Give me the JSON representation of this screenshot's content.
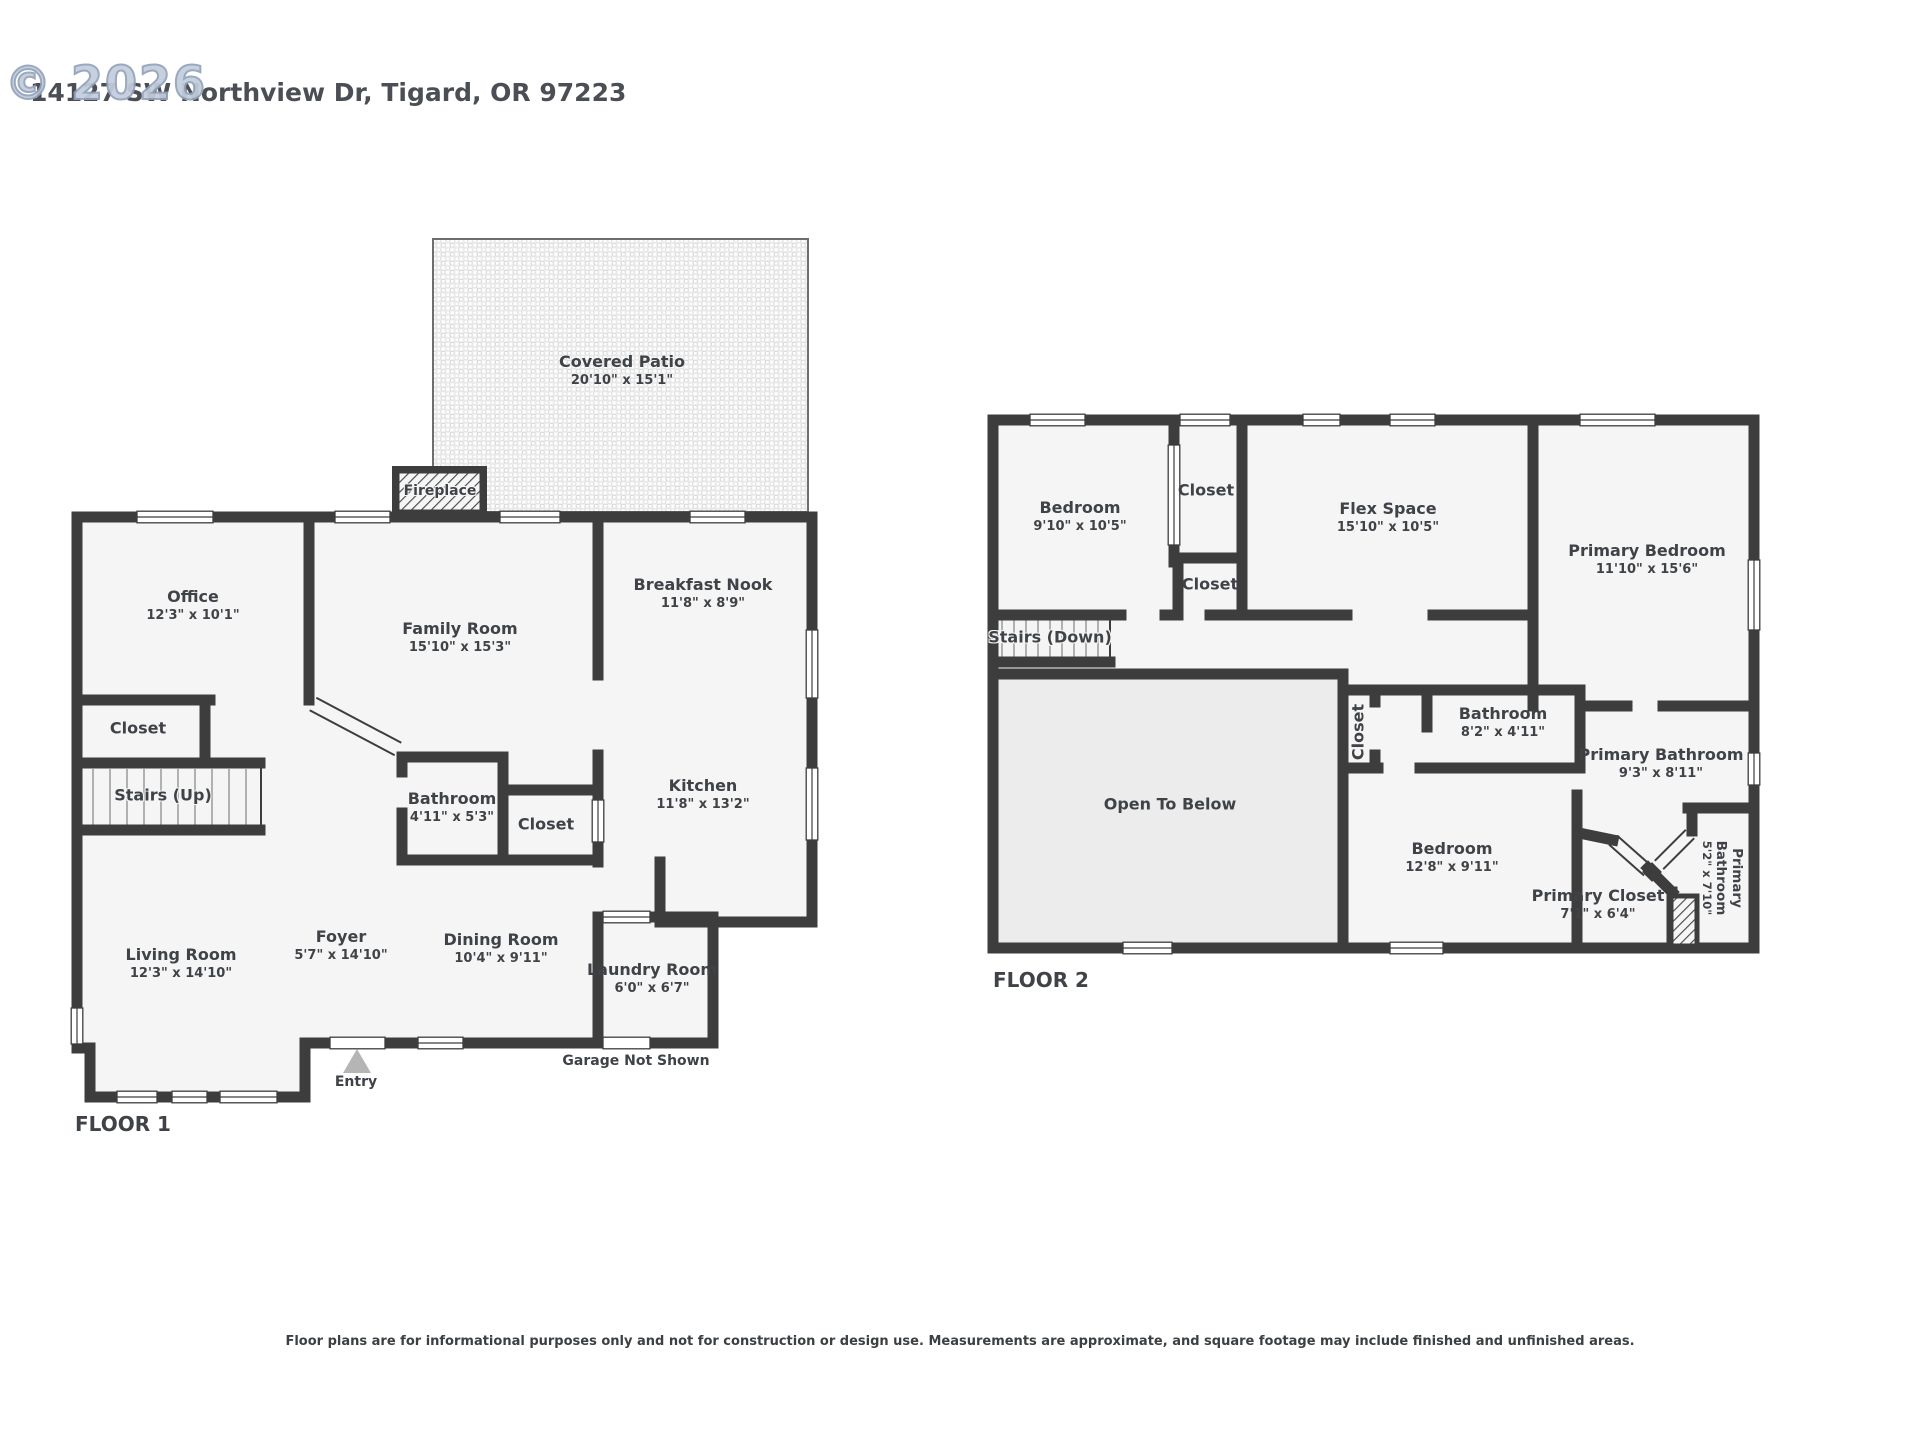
{
  "watermark": "© 2026",
  "address": "14127 SW Northview Dr, Tigard, OR 97223",
  "floor1": {
    "label": "FLOOR 1",
    "rooms": {
      "covered_patio": {
        "name": "Covered Patio",
        "dims": "20'10\" x 15'1\""
      },
      "fireplace": {
        "name": "Fireplace"
      },
      "office": {
        "name": "Office",
        "dims": "12'3\" x 10'1\""
      },
      "family_room": {
        "name": "Family Room",
        "dims": "15'10\" x 15'3\""
      },
      "breakfast_nook": {
        "name": "Breakfast Nook",
        "dims": "11'8\" x 8'9\""
      },
      "kitchen": {
        "name": "Kitchen",
        "dims": "11'8\" x 13'2\""
      },
      "bathroom": {
        "name": "Bathroom",
        "dims": "4'11\" x 5'3\""
      },
      "closet_hall": {
        "name": "Closet"
      },
      "closet_office": {
        "name": "Closet"
      },
      "stairs_up": {
        "name": "Stairs (Up)"
      },
      "living_room": {
        "name": "Living Room",
        "dims": "12'3\" x 14'10\""
      },
      "foyer": {
        "name": "Foyer",
        "dims": "5'7\" x 14'10\""
      },
      "dining_room": {
        "name": "Dining Room",
        "dims": "10'4\" x 9'11\""
      },
      "laundry_room": {
        "name": "Laundry Room",
        "dims": "6'0\" x 6'7\""
      },
      "entry": {
        "name": "Entry"
      },
      "garage_note": {
        "name": "Garage Not Shown"
      }
    }
  },
  "floor2": {
    "label": "FLOOR 2",
    "rooms": {
      "bedroom_left": {
        "name": "Bedroom",
        "dims": "9'10\" x 10'5\""
      },
      "closet_upper": {
        "name": "Closet"
      },
      "closet_lower": {
        "name": "Closet"
      },
      "flex_space": {
        "name": "Flex Space",
        "dims": "15'10\" x 10'5\""
      },
      "primary_bedroom": {
        "name": "Primary Bedroom",
        "dims": "11'10\" x 15'6\""
      },
      "stairs_down": {
        "name": "Stairs (Down)"
      },
      "open_to_below": {
        "name": "Open To Below"
      },
      "closet_hall": {
        "name": "Closet"
      },
      "bathroom": {
        "name": "Bathroom",
        "dims": "8'2\" x 4'11\""
      },
      "primary_bathroom": {
        "name": "Primary Bathroom",
        "dims": "9'3\" x 8'11\""
      },
      "bedroom_bottom": {
        "name": "Bedroom",
        "dims": "12'8\" x 9'11\""
      },
      "primary_closet": {
        "name": "Primary Closet",
        "dims": "7'1\" x 6'4\""
      },
      "primary_bathroom_small": {
        "name": "Primary Bathroom",
        "dims": "5'2\" x 7'10\""
      }
    }
  },
  "disclaimer": "Floor plans are for informational purposes only and not for construction or design use. Measurements are approximate, and square footage may include finished and unfinished areas.",
  "colors": {
    "wall": "#3d3d3d",
    "room_fill": "#f5f5f5",
    "open_to_below_fill": "#ececec",
    "entry_marker": "#b5b5b5",
    "watermark": "#9fadc2"
  }
}
